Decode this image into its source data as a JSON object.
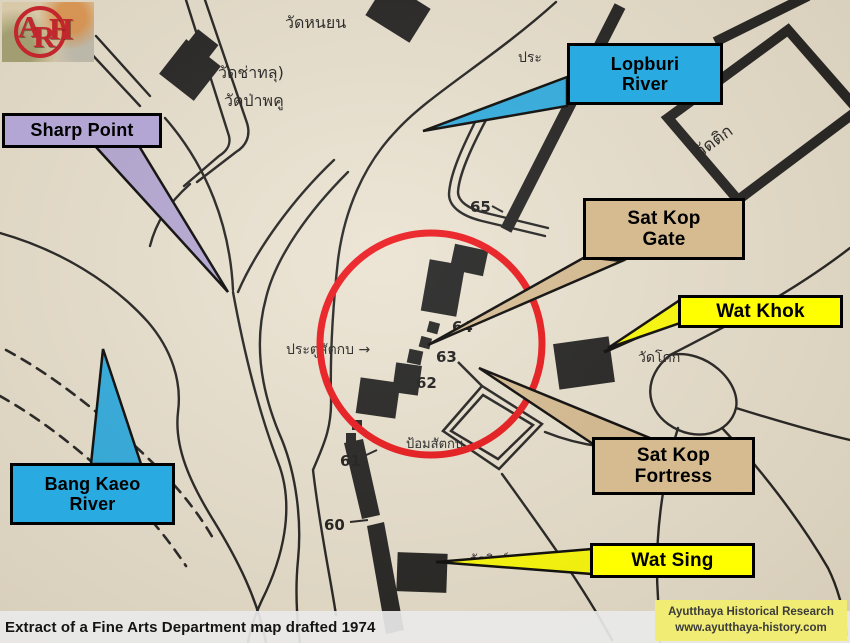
{
  "page": {
    "caption": "Extract of a Fine Arts Department map drafted 1974"
  },
  "logo": {
    "letter_a": "A",
    "letter_r": "R",
    "letter_h": "H",
    "color": "#c1272d"
  },
  "credit": {
    "line1": "Ayutthaya Historical Research",
    "line2": "www.ayutthaya-history.com",
    "bg": "#f1ed74"
  },
  "callouts": {
    "lopburi_river": {
      "label": "Lopburi\nRiver",
      "color": "#29abe2"
    },
    "sharp_point": {
      "label": "Sharp Point",
      "color": "#b3a6d5"
    },
    "sat_kop_gate": {
      "label": "Sat Kop\nGate",
      "color": "#d6bb90"
    },
    "wat_khok": {
      "label": "Wat Khok",
      "color": "#ffff00"
    },
    "sat_kop_fortress": {
      "label": "Sat Kop\nFortress",
      "color": "#d6bb90"
    },
    "bang_kaeo_river": {
      "label": "Bang Kaeo\nRiver",
      "color": "#29abe2"
    },
    "wat_sing": {
      "label": "Wat Sing",
      "color": "#ffff00"
    }
  },
  "map_labels": {
    "wat_nayen": "วัดหนยน",
    "wat_chathalu": "วัดช่าทลุ)",
    "wat_papaku": "วัดป่าพคู",
    "pratu_fragment": "ประ",
    "wat_tik": "วัดติก",
    "pratu_sat_kop": "ประตูสัตกบ →",
    "wat_khok_thai": "วัดโคก",
    "fortress_thai": "ป้อมสัตกบ",
    "wat_sing_thai": "วัดสิงห์",
    "gates": [
      "60",
      "61",
      "62",
      "63",
      "64",
      "65"
    ]
  },
  "colors": {
    "map_background": "#eae2d0",
    "ink": "#1b1b1b",
    "highlight_circle": "#ea1015"
  }
}
